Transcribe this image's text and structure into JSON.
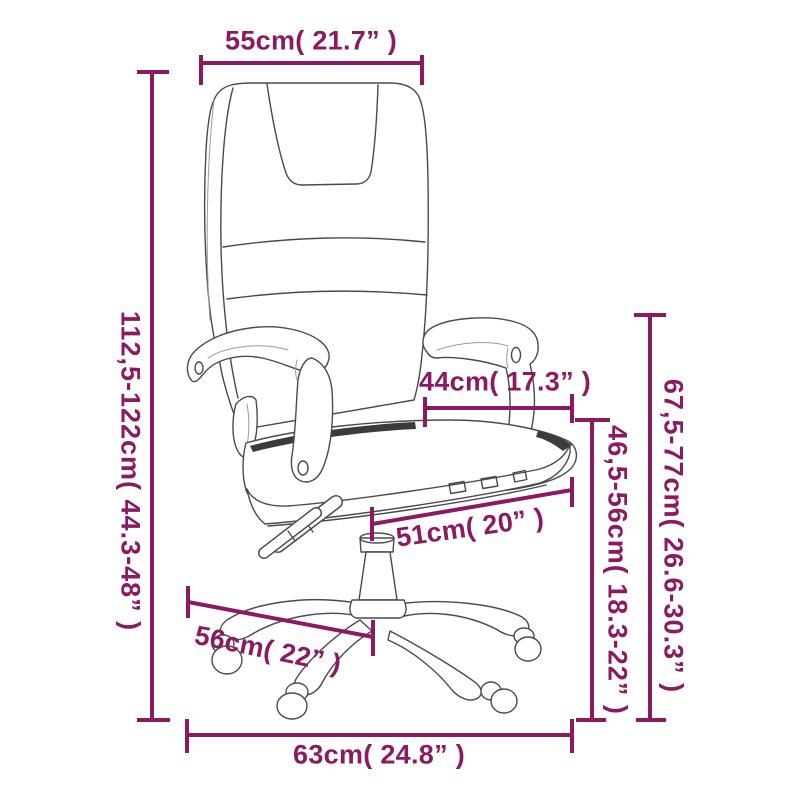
{
  "colors": {
    "accent": "#8B1A63",
    "sketch": "#4A4A4A",
    "sketch_light": "#9C9C9C",
    "seam": "#3B3B3B"
  },
  "labels": {
    "top_width": "55cm( 21.7” )",
    "overall_height": "112,5-122cm( 44.3-48” )",
    "armrest_height": "67,5-77cm( 26.6-30.3” )",
    "seat_height": "46,5-56cm( 18.3-22” )",
    "backrest_width": "44cm( 17.3” )",
    "seat_depth": "51cm( 20” )",
    "base_width": "56cm( 22” )",
    "overall_depth": "63cm( 24.8” )"
  }
}
